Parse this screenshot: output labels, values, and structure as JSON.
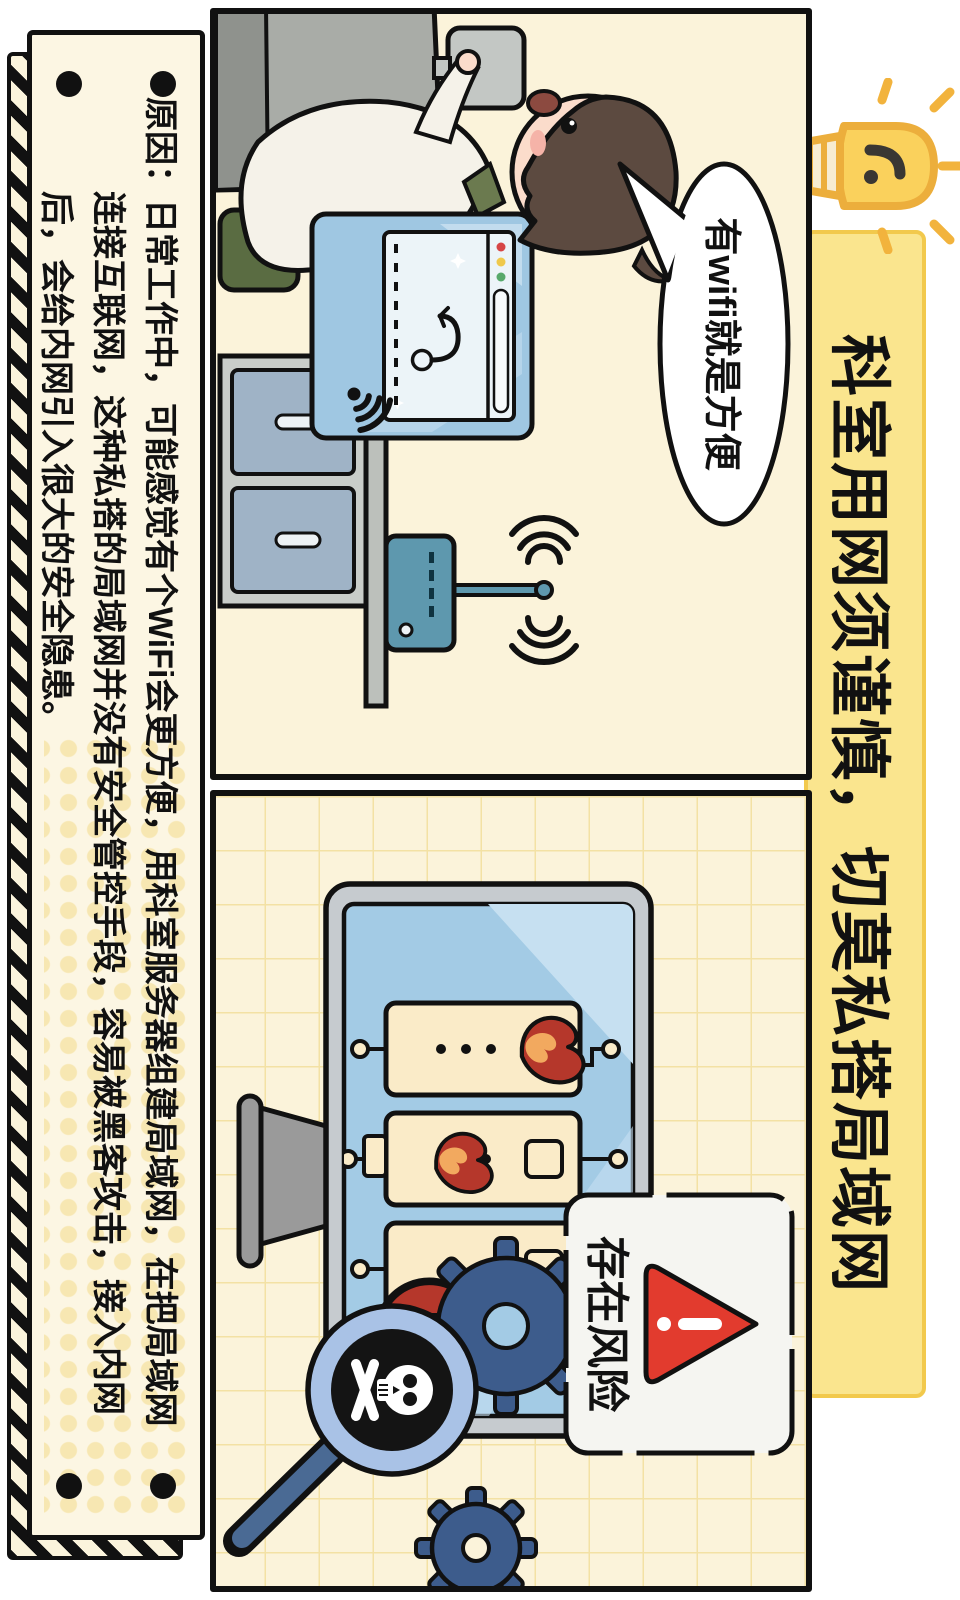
{
  "poster": {
    "title": "科室用网须谨慎，切莫私搭局域网",
    "panel1": {
      "speech_bubble": "有wifi就是方便"
    },
    "panel2": {
      "warning_label": "存在风险"
    },
    "note_lines": [
      "原因：日常工作中，可能感觉有个WiFi会更方便，用科室服务器组建局域网，在把局域网",
      "连接互联网，这种私搭的局域网并没有安全管控手段，容易被黑客攻击，接入内网",
      "后，会给内网引入很大的安全隐患。"
    ],
    "icons": {
      "lightbulb": "lightbulb-icon",
      "wifi_waves": "wifi-waves-icon",
      "wifi_on_screen": "wifi-screen-icon",
      "phishing_hook": "phishing-hook-icon",
      "router": "wifi-router-icon",
      "flame": "flame-icon",
      "gear": "gear-icon",
      "skull_magnifier": "skull-magnifier-icon",
      "warning_triangle": "warning-triangle-icon"
    },
    "colors": {
      "title_band_bg": "#FAE58E",
      "title_band_border": "#F2C94C",
      "panel_bg": "#FBF3DA",
      "grid_line": "#F3E1A4",
      "screen_blue": "#A3CBE5",
      "server_cream": "#FAEBC8",
      "flame_red": "#B5372B",
      "flame_orange": "#F2A95F",
      "gear_blue": "#3D5C8C",
      "warning_red": "#E23B2E",
      "router_teal": "#5E98AE",
      "hair_brown": "#5C4A40",
      "chair_green": "#5A6C42",
      "note_bg": "#FCF6E3"
    }
  }
}
